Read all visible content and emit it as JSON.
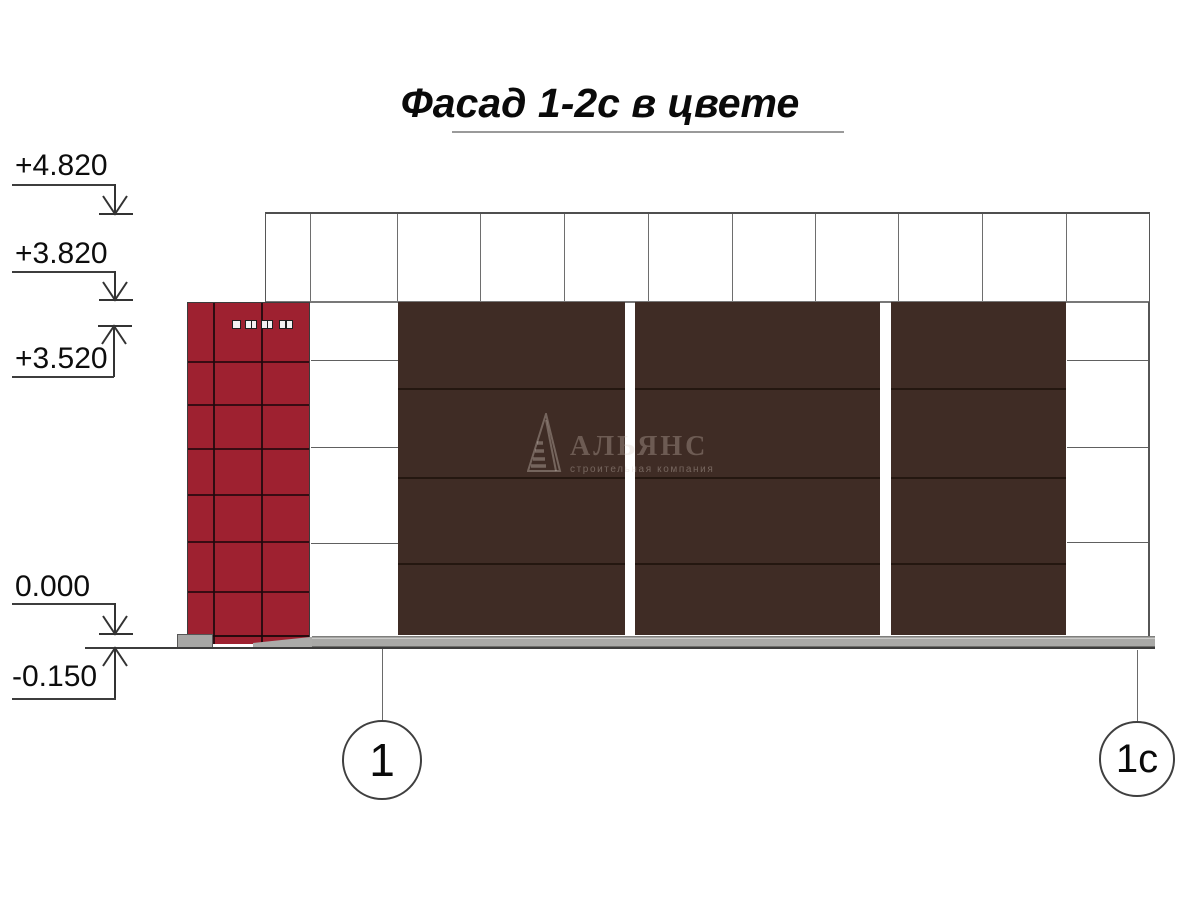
{
  "title": "Фасад 1-2с в цвете",
  "elevation_marks": [
    {
      "label": "+4.820"
    },
    {
      "label": "+3.820"
    },
    {
      "label": "+3.520"
    },
    {
      "label": "0.000"
    },
    {
      "label": "-0.150"
    }
  ],
  "axis_markers": [
    {
      "label": "1"
    },
    {
      "label": "1с"
    }
  ],
  "watermark": {
    "company": "АЛЬЯНС",
    "tagline": "строительная компания"
  },
  "colors": {
    "red_tile": "#9e2130",
    "brown_panel": "#3f2c25",
    "plinth_gray": "#a9a9a7",
    "drawing_line": "#4f4f4f"
  }
}
